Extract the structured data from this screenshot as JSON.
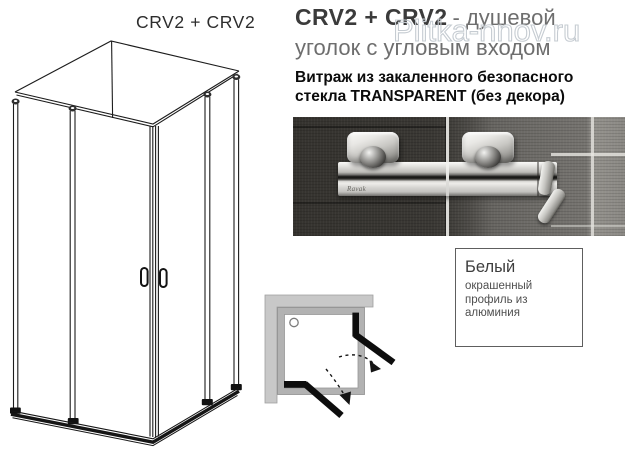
{
  "drawing": {
    "label": "CRV2 + CRV2"
  },
  "header": {
    "model": "CRV2 + CRV2",
    "subtitle_line1": "- душевой",
    "subtitle_line2": "уголок с угловым  входом",
    "watermark": "Plitka-nnov.ru"
  },
  "glass_note": {
    "line1": "Витраж из закаленного безопасного",
    "line2": "стекла TRANSPARENT (без декора)"
  },
  "photo": {
    "brand_mark": "Ravak"
  },
  "profile_box": {
    "title": "Белый",
    "description": "окрашенный профиль из алюминия"
  },
  "colors": {
    "line_dark": "#1c1c1c",
    "door_black": "#0d0d0d",
    "wall_gray": "#c8c8c8",
    "frame_gray": "#b2b2b2",
    "tile_dark": "#3a3834",
    "tile_light": "#8b8984",
    "chrome": "#d6d5d2",
    "watermark_gray": "#c6ccd2",
    "subtitle_gray": "#6e6e6e"
  }
}
